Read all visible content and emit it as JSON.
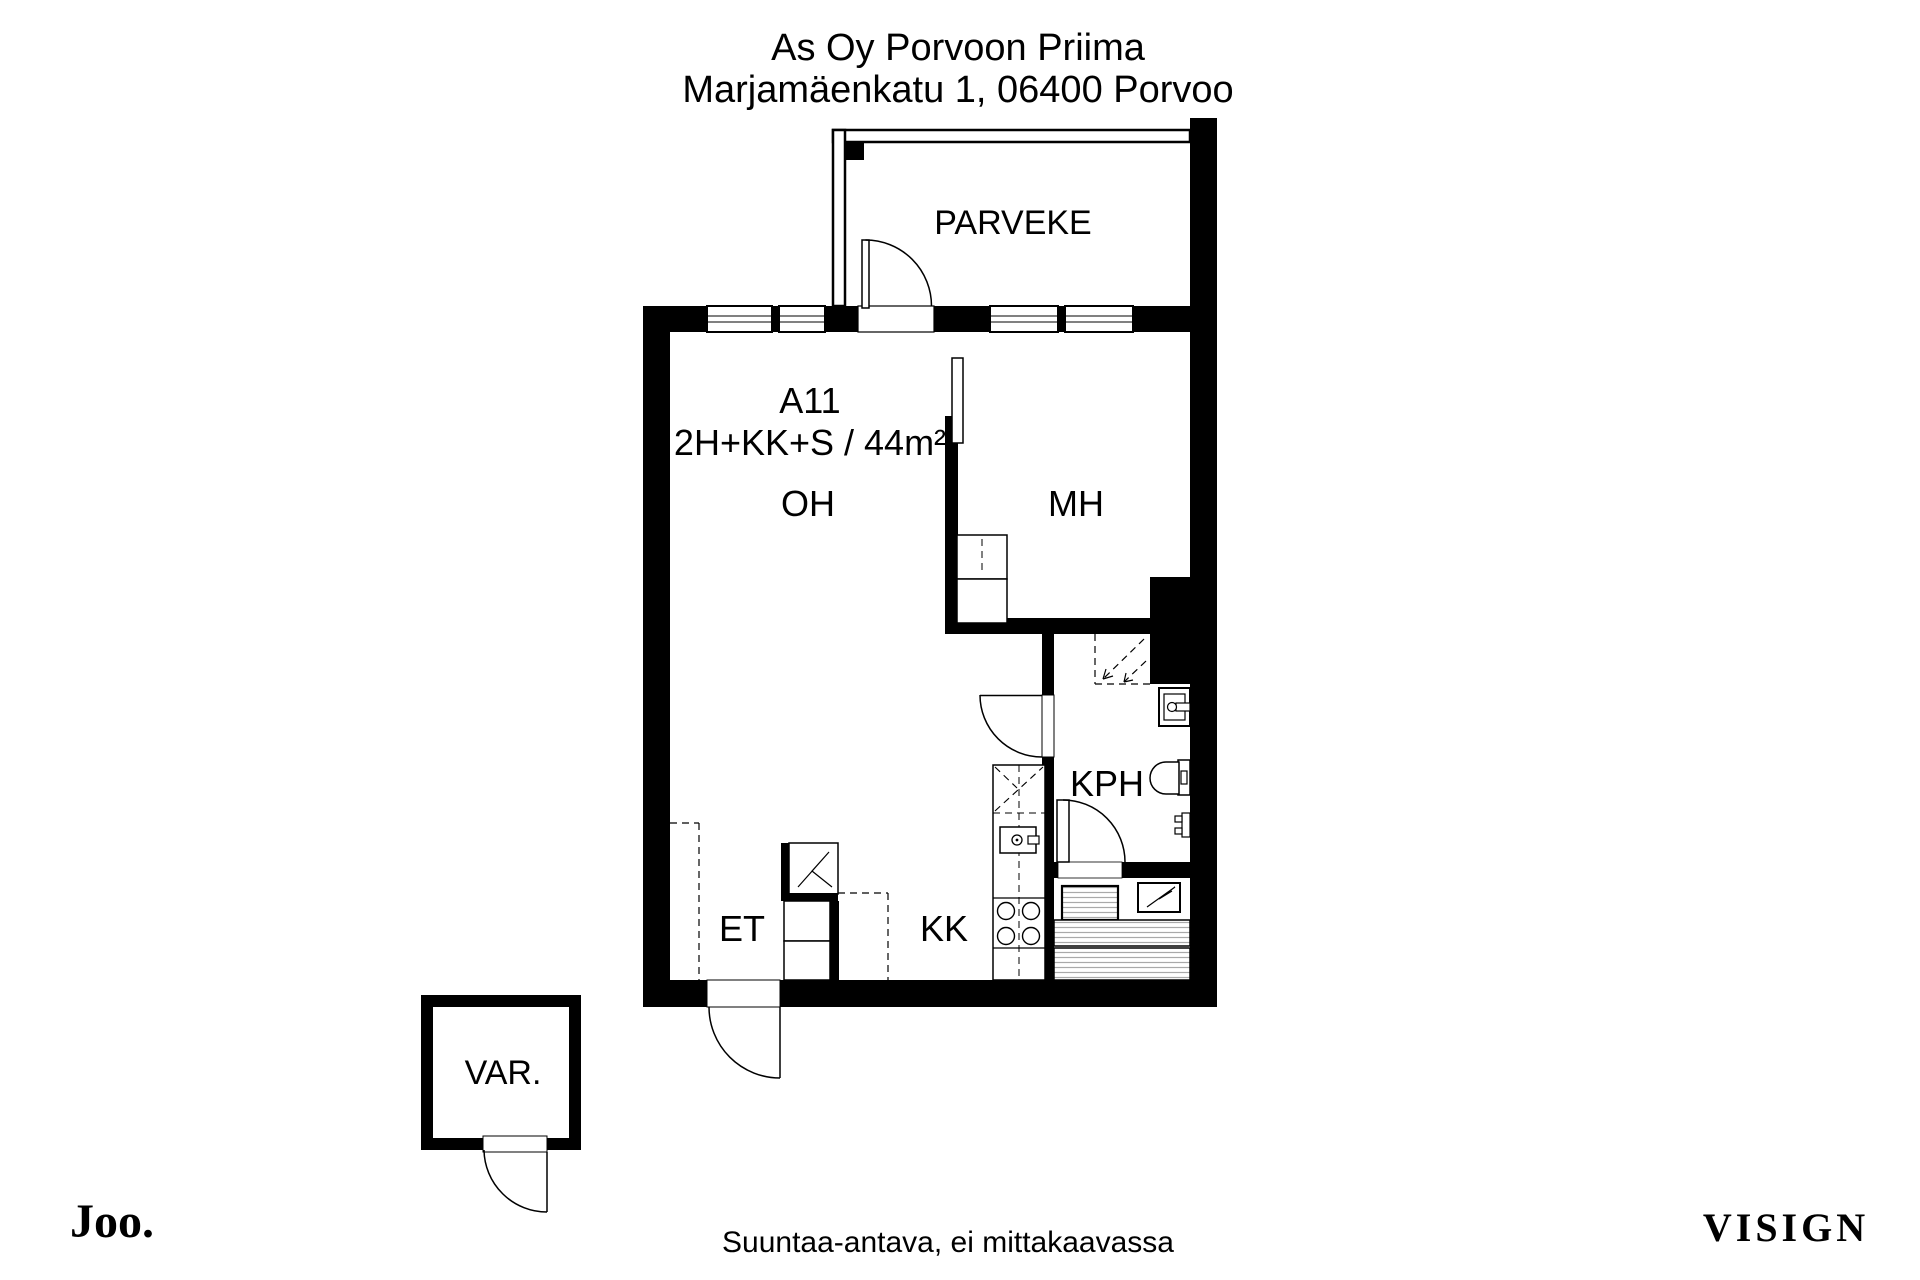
{
  "header": {
    "building_name": "As Oy Porvoon Priima",
    "address": "Marjamäenkatu 1, 06400 Porvoo"
  },
  "apartment": {
    "unit_id": "A11",
    "type_area": "2H+KK+S / 44m²"
  },
  "rooms": {
    "balcony": "PARVEKE",
    "living_room": "OH",
    "bedroom": "MH",
    "bathroom": "KPH",
    "hallway": "ET",
    "kitchenette": "KK",
    "storage": "VAR."
  },
  "footer": {
    "agency_logo": "Joo.",
    "disclaimer": "Suuntaa-antava, ei mittakaavassa",
    "watermark": "VISIGN"
  },
  "colors": {
    "line_black": "#000000",
    "logo_green": "#2f4e1e",
    "disclaimer_gray": "#878787",
    "watermark_gray": "#efecec"
  }
}
